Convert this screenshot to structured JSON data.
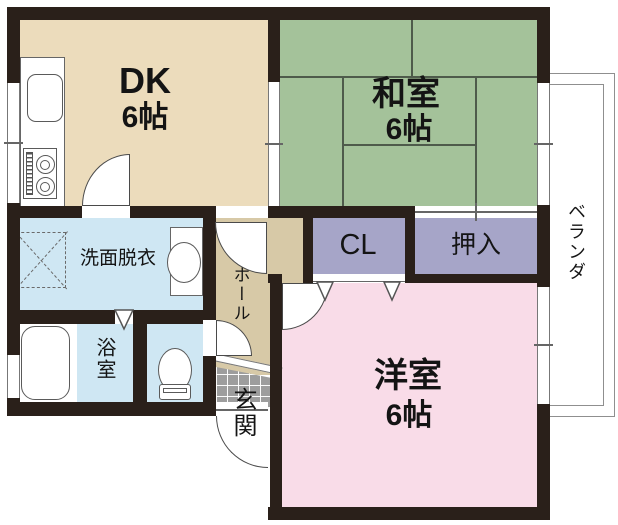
{
  "rooms": {
    "dk": {
      "label": "DK",
      "size": "6帖"
    },
    "washitsu": {
      "label": "和室",
      "size": "6帖"
    },
    "youshitsu": {
      "label": "洋室",
      "size": "6帖"
    },
    "cl": {
      "label": "CL"
    },
    "oshiire": {
      "label": "押入"
    },
    "senmen_datsui": {
      "label": "洗面脱衣"
    },
    "yokushitsu": {
      "label": "浴室"
    },
    "hall": {
      "label": "ホール"
    },
    "genkan": {
      "label": "玄関"
    },
    "veranda": {
      "label": "ベランダ"
    }
  },
  "colors": {
    "wall": "#2a201a",
    "dk_floor": "#ecdcbc",
    "washitsu_floor": "#a4c29a",
    "youshitsu_floor": "#f9dce8",
    "closet_floor": "#a6a5c8",
    "wet_floor": "#cfe7f3",
    "hall_floor": "#d7c9a7",
    "tile": "#9d9d9d",
    "tatami_line": "#4e5b4b",
    "balcony_line": "#8f8f8f"
  }
}
